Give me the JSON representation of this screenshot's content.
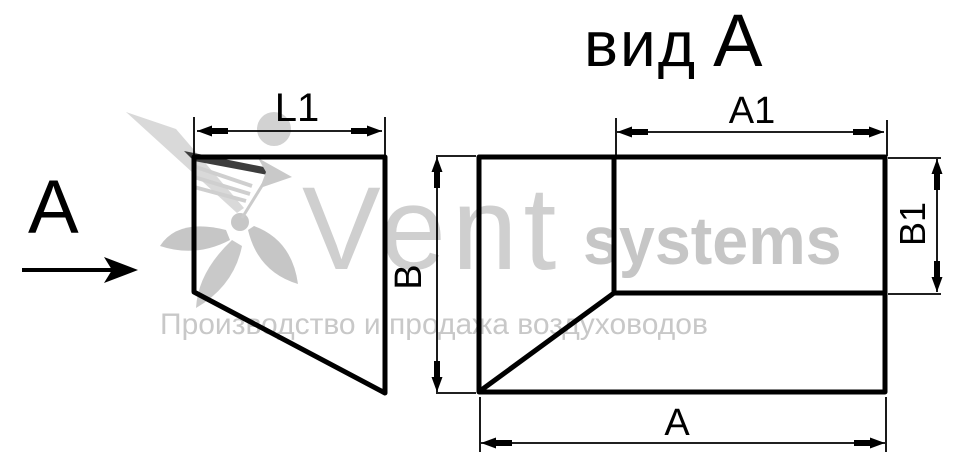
{
  "canvas": {
    "background": "#ffffff",
    "line_color": "#000000"
  },
  "title": {
    "prefix": "вид",
    "letter": "А"
  },
  "view_marker": {
    "label": "А"
  },
  "side_view": {
    "dim_length_label": "L1"
  },
  "front_view": {
    "dim_width_top_label": "A1",
    "dim_width_bottom_label": "А",
    "dim_height_left_label": "В",
    "dim_height_right_label": "B1"
  },
  "watermark": {
    "brand": "Vent",
    "brand_suffix": "systems",
    "tagline": "Производство и продажа воздуховодов",
    "color_light": "#d9d9d9",
    "color_mid": "#c9c9c9",
    "color_text": "#cfcfcf"
  }
}
